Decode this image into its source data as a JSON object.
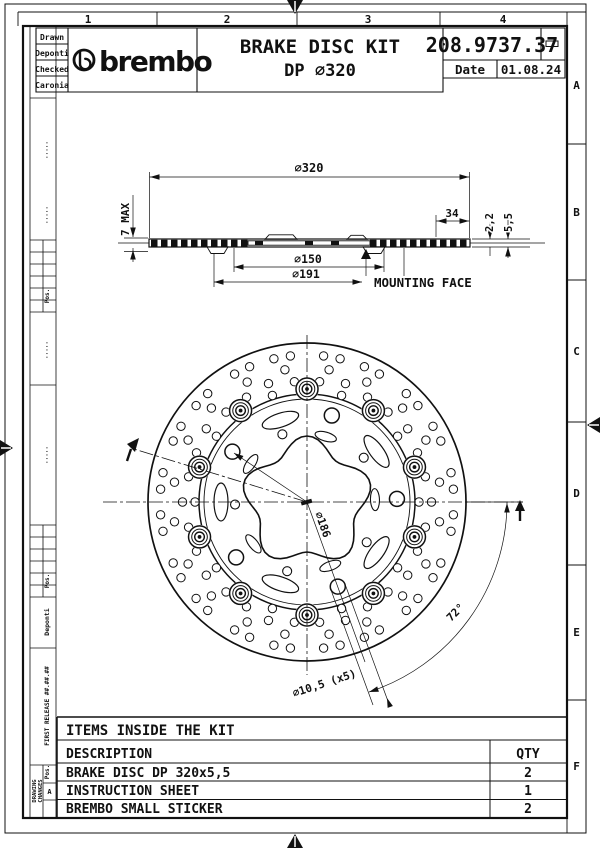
{
  "sheet": {
    "grid_cols": [
      "1",
      "2",
      "3",
      "4"
    ],
    "grid_rows": [
      "A",
      "B",
      "C",
      "D",
      "E",
      "F"
    ]
  },
  "title_block": {
    "drawn_label": "Drawn",
    "drawn_value": "Deponti",
    "checked_label": "Checked",
    "checked_value": "Caronia",
    "brand": "brembo",
    "title_line1": "BRAKE DISC KIT",
    "title_line2": "DP ⌀320",
    "part_number": "208.9737.37",
    "date_label": "Date",
    "date_value": "01.08.24"
  },
  "revision_strip": {
    "drawing_changes_line1": "DRAWING",
    "drawing_changes_line2": "CHANGES",
    "rev": "A",
    "pos_label": "Pos.",
    "first_release": "FIRST RELEASE ##.##.##",
    "author": "Deponti",
    "dots": "·····"
  },
  "section_view": {
    "dim_outer_diameter": "⌀320",
    "dim_band_width": "34",
    "dim_thickness_inner": "2,2",
    "dim_thickness_total": "5,5",
    "dim_max_height": "7 MAX",
    "dim_d150": "⌀150",
    "dim_d191": "⌀191",
    "mounting_face": "MOUNTING FACE"
  },
  "front_view": {
    "dim_bolt_circle": "⌀186",
    "dim_holes": "⌀10,5 (x5)",
    "dim_angle": "72°"
  },
  "kit_table": {
    "title": "ITEMS INSIDE THE KIT",
    "col_description": "DESCRIPTION",
    "col_qty": "QTY",
    "rows": [
      {
        "description": "BRAKE DISC DP 320x5,5",
        "qty": "2"
      },
      {
        "description": "INSTRUCTION SHEET",
        "qty": "1"
      },
      {
        "description": "BREMBO SMALL STICKER",
        "qty": "2"
      }
    ]
  },
  "colors": {
    "ink": "#111111",
    "paper": "#ffffff"
  }
}
